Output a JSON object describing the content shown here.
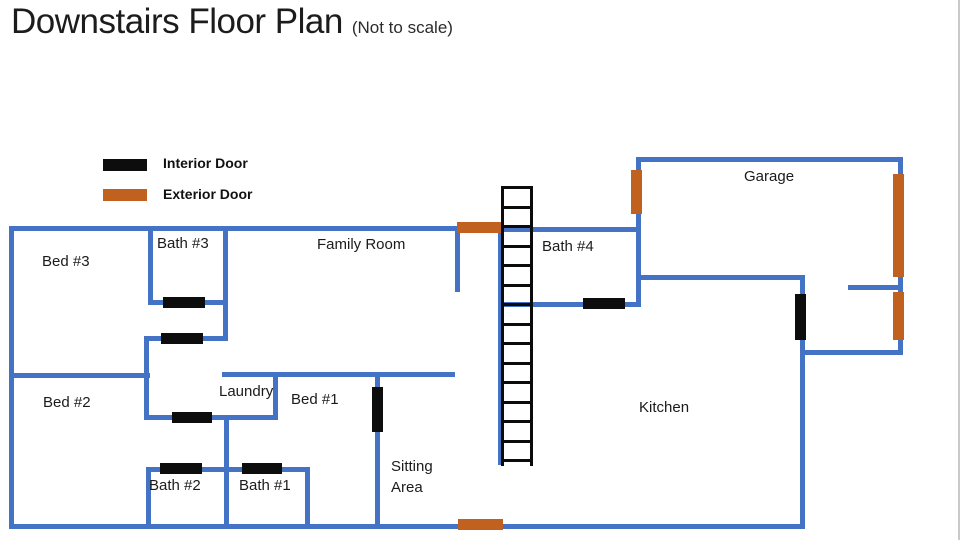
{
  "title": "Downstairs Floor Plan",
  "subtitle": "(Not to scale)",
  "legend": {
    "interior_label": "Interior Door",
    "exterior_label": "Exterior Door"
  },
  "colors": {
    "wall": "#4472C4",
    "interior_door": "#0d0d0d",
    "exterior_door": "#C06120",
    "text": "#1b1b1b"
  },
  "rooms": {
    "bed3": "Bed #3",
    "bath3": "Bath #3",
    "family_room": "Family Room",
    "bath4": "Bath #4",
    "garage": "Garage",
    "bed2": "Bed #2",
    "laundry": "Laundry",
    "bed1": "Bed #1",
    "kitchen": "Kitchen",
    "sitting_area": "Sitting Area",
    "bath2": "Bath #2",
    "bath1": "Bath #1"
  },
  "stairs": {
    "rung_count": 15,
    "rung_spacing_px": 19.5
  }
}
